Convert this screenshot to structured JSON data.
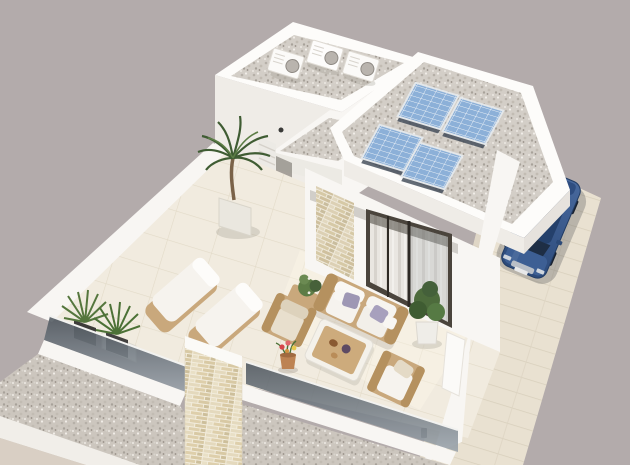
{
  "scene": {
    "type": "3d-architectural-render",
    "description": "Aerial 3D rendering of a modern white flat-roof villa: upper roof deck with three air-conditioning units, lower gravel roof with four tilted solar panels, furnished roof terrace with rattan lounge set, two sun loungers, potted plants, glass balustrade, stone-clad pillar, sliding glass door with curtains, and a dark blue sedan parked on a paved driveway.",
    "objects": {
      "ac_units": 3,
      "solar_panels": 4,
      "sun_loungers": 2,
      "sofas": 1,
      "armchairs": 2,
      "coffee_tables": 1,
      "side_tables": 1,
      "potted_plants": 6,
      "cars": 1
    }
  },
  "colors": {
    "background": "#b3abab",
    "wall_white": "#f8f6f3",
    "wall_bright": "#fdfcfa",
    "wall_shade": "#efece7",
    "wall_dark": "#e6e2dd",
    "gravel_base": "#d5d0c9",
    "gravel_dark": "#c8c2ba",
    "tile_floor": "#f1ebdf",
    "driveway": "#e9e1d1",
    "paver_line": "#d8cfbc",
    "panel_blue": "#8cb0d8",
    "panel_grid": "#eef3f8",
    "panel_shadow": "#3c4654",
    "door_frame": "#4a443c",
    "curtain_light": "#e9e6e1",
    "glass_dark": "#4e565e",
    "glass_light": "#9aa3ab",
    "stone_beige": "#d6c9a6",
    "car_body": "#35548a",
    "car_roof": "#24406b",
    "car_glass": "#1b2c44",
    "wicker": "#c9a87c",
    "wicker_dark": "#b5915f",
    "cushion_white": "#f6f3ee",
    "cushion_beige": "#e8dfcd",
    "pillow_lavender": "#9e97b4",
    "plant_green": "#4d6b3c",
    "plant_dark_pot": "#3e3c39",
    "terracotta": "#bd8353",
    "lower_wall_beige": "#d9cfc4"
  }
}
